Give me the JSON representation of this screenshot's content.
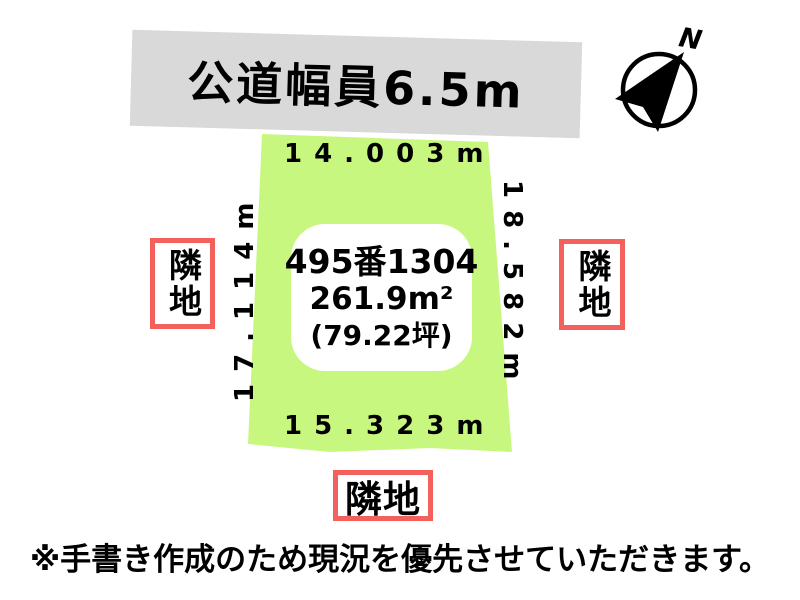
{
  "road": {
    "label": "公道幅員6.5m"
  },
  "compass": {
    "north_label": "N"
  },
  "plot": {
    "parcel_number": "495番1304",
    "area_sqm": "261.9m²",
    "area_tsubo": "(79.22坪)",
    "dim_top": "14.003m",
    "dim_bottom": "15.323m",
    "dim_left": "17.114m",
    "dim_right": "18.582m"
  },
  "neighbors": {
    "left": "隣地",
    "right": "隣地",
    "bottom": "隣地"
  },
  "note": {
    "text": "※手書き作成のため現況を優先させていただきます。"
  },
  "colors": {
    "plot_fill": "#c8f780",
    "road_banner": "#d9d9d9",
    "neighbor_border": "#f4605c",
    "ink": "#000000"
  }
}
